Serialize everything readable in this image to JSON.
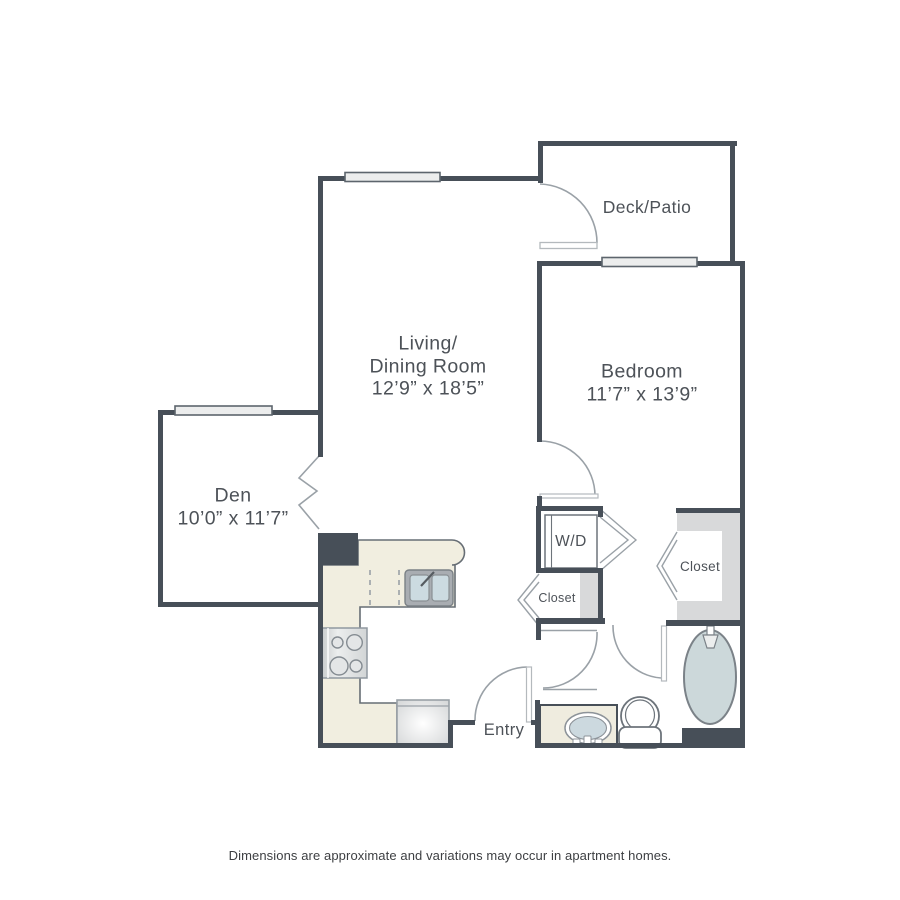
{
  "rooms": {
    "deck": {
      "label": "Deck/Patio"
    },
    "living": {
      "label_line1": "Living/",
      "label_line2": "Dining Room",
      "dimensions": "12’9” x 18’5”"
    },
    "bedroom": {
      "label": "Bedroom",
      "dimensions": "11’7” x 13’9”"
    },
    "den": {
      "label": "Den",
      "dimensions": "10’0” x 11’7”"
    },
    "washer_dryer": {
      "label": "W/D"
    },
    "hall_closet": {
      "label": "Closet"
    },
    "bedroom_closet": {
      "label": "Closet"
    },
    "entry": {
      "label": "Entry"
    }
  },
  "footer": {
    "disclaimer": "Dimensions are approximate and variations may occur in apartment homes."
  },
  "colors": {
    "wall": "#474f58",
    "thin_line": "#9aa1a7",
    "counter": "#f1eee0",
    "closet_shading": "#d8d9da",
    "fixture_blue": "#ccd8da",
    "text": "#4d5258"
  }
}
